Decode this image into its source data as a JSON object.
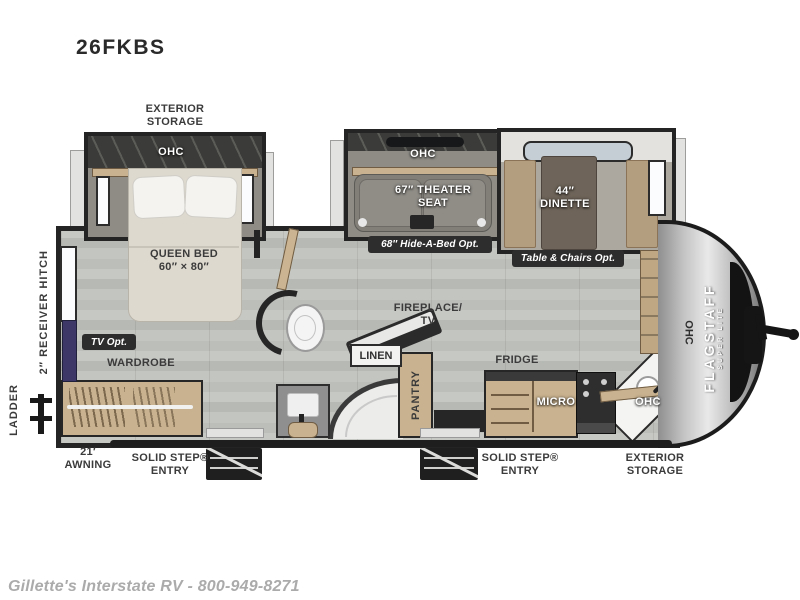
{
  "model": "26FKBS",
  "dealer_watermark": "Gillette's Interstate RV - 800-949-8271",
  "brand": {
    "name": "FLAGSTAFF",
    "sub": "SUPER LITE"
  },
  "exterior": {
    "storage_top_line1": "EXTERIOR",
    "storage_top_line2": "STORAGE",
    "awning_line1": "21′",
    "awning_line2": "AWNING",
    "entry1_line1": "SOLID STEP®",
    "entry1_line2": "ENTRY",
    "entry2_line1": "SOLID STEP®",
    "entry2_line2": "ENTRY",
    "storage_front_line1": "EXTERIOR",
    "storage_front_line2": "STORAGE",
    "receiver_hitch": "2″ RECEIVER HITCH",
    "ladder": "LADDER"
  },
  "bedroom": {
    "ohc": "OHC",
    "bed_line1": "QUEEN BED",
    "bed_line2": "60″ × 80″",
    "tv_opt": "TV Opt.",
    "wardrobe": "WARDROBE"
  },
  "living": {
    "ohc": "OHC",
    "theater_line1": "67″ THEATER",
    "theater_line2": "SEAT",
    "hide_a_bed_opt": "68″ Hide-A-Bed Opt.",
    "dinette_line1": "44″",
    "dinette_line2": "DINETTE",
    "table_chairs_opt": "Table & Chairs Opt.",
    "fireplace_line1": "FIREPLACE/",
    "fireplace_line2": "TV"
  },
  "bathroom": {
    "linen": "LINEN",
    "pantry": "PANTRY"
  },
  "kitchen": {
    "fridge": "FRIDGE",
    "micro": "MICRO",
    "ohc": "OHC",
    "ohc_front": "OHC"
  },
  "colors": {
    "wall": "#242424",
    "floor": "#c1c3bf",
    "wood": "#c9b28f",
    "badge": "#2d2d2d",
    "cap_silver": "#c4c4c4",
    "bed": "#ded9cf"
  }
}
